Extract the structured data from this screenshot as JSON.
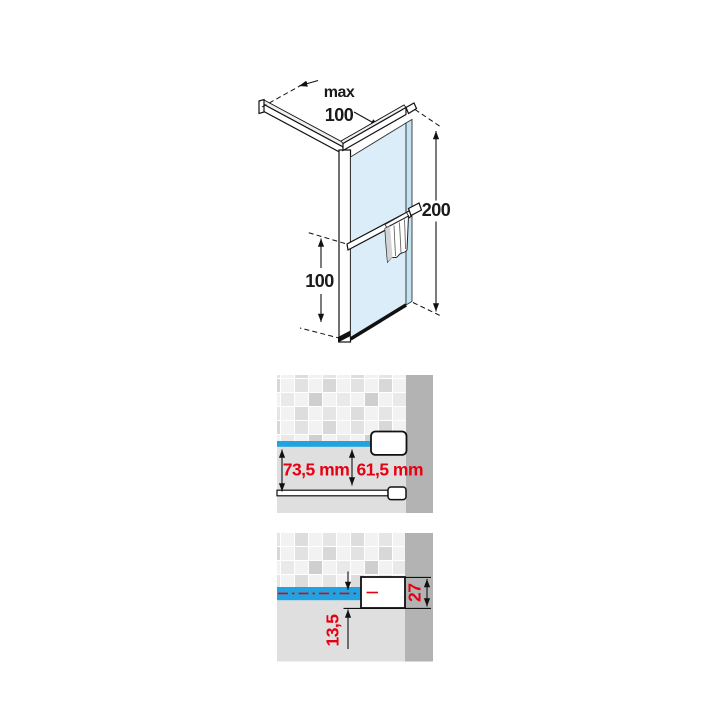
{
  "colors": {
    "accent_blue": "#21A3E1",
    "dim_red": "#E60013",
    "wall_gray": "#B3B3B3",
    "floor_gray": "#DFDFDF",
    "glass_fill": "#DAEDF8",
    "glass_edge": "#C3E2F2"
  },
  "isometric_view": {
    "max_label": "max",
    "arm_length": "100",
    "panel_height": "200",
    "bar_height": "100"
  },
  "plan_view": {
    "left_dim": "73,5 mm",
    "right_dim": "61,5 mm"
  },
  "section_view": {
    "profile_depth": "27",
    "center_offset": "13,5"
  }
}
